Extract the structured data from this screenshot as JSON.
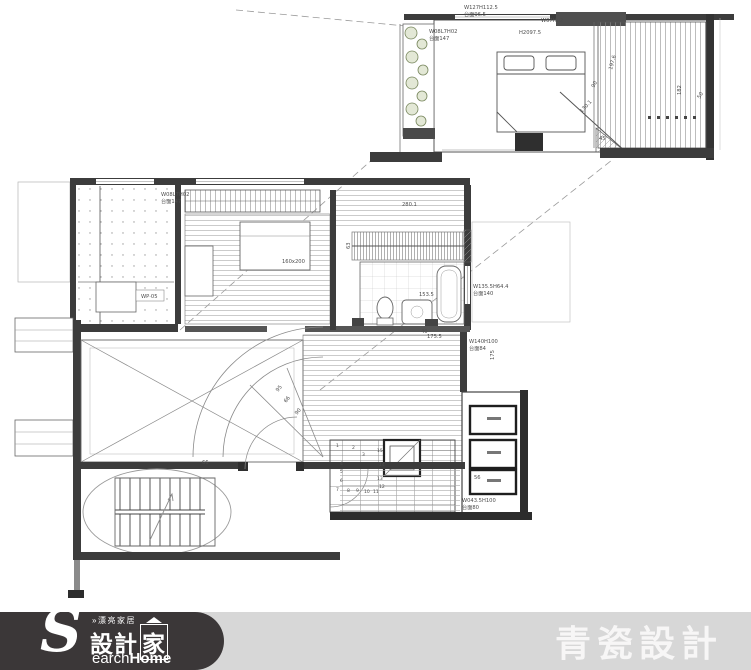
{
  "footer": {
    "logo": {
      "small_text": "»漂亮家居",
      "brand_s": "S",
      "brand_zh_prefix": "設計",
      "brand_zh_boxed": "家",
      "brand_en_rest": "earch",
      "brand_en_bold": "Home"
    },
    "studio_name": "青瓷設計",
    "colors": {
      "bar": "#d7d7d7",
      "logo_bg": "#3b3738",
      "text": "#ffffff"
    }
  },
  "plan": {
    "colors": {
      "wall": "#3c3c3c",
      "thin_line": "#8a8a8a",
      "plant": "#77865c"
    },
    "labels": [
      {
        "t": "W127H112.5",
        "x": 464,
        "y": 9
      },
      {
        "t": "台面96.5",
        "x": 464,
        "y": 16
      },
      {
        "t": "W07H02",
        "x": 541,
        "y": 22
      },
      {
        "t": "H2097.5",
        "x": 519,
        "y": 34
      },
      {
        "t": "W08L7H02",
        "x": 429,
        "y": 33
      },
      {
        "t": "台面147",
        "x": 429,
        "y": 40
      },
      {
        "t": "197.6",
        "x": 612,
        "y": 70,
        "r": -75
      },
      {
        "t": "90",
        "x": 594,
        "y": 88,
        "r": -60
      },
      {
        "t": "130.1",
        "x": 582,
        "y": 113,
        "r": -48
      },
      {
        "t": "45",
        "x": 599,
        "y": 140
      },
      {
        "t": "182",
        "x": 681,
        "y": 95,
        "r": -90
      },
      {
        "t": "50",
        "x": 700,
        "y": 99,
        "r": -60
      },
      {
        "t": "W08L7H02",
        "x": 161,
        "y": 196
      },
      {
        "t": "台面147",
        "x": 161,
        "y": 203
      },
      {
        "t": "280.1",
        "x": 402,
        "y": 206
      },
      {
        "t": "63",
        "x": 350,
        "y": 249,
        "r": -90
      },
      {
        "t": "160x200",
        "x": 282,
        "y": 263
      },
      {
        "t": "WP·05",
        "x": 141,
        "y": 298
      },
      {
        "t": "153.5",
        "x": 419,
        "y": 296
      },
      {
        "t": "40",
        "x": 421,
        "y": 333
      },
      {
        "t": "W135.5H64.4",
        "x": 473,
        "y": 288
      },
      {
        "t": "台面140",
        "x": 473,
        "y": 295
      },
      {
        "t": "W140H100",
        "x": 469,
        "y": 343
      },
      {
        "t": "台面84",
        "x": 469,
        "y": 350
      },
      {
        "t": "175",
        "x": 494,
        "y": 360,
        "r": -90
      },
      {
        "t": "175.5",
        "x": 427,
        "y": 338
      },
      {
        "t": "66",
        "x": 202,
        "y": 464
      },
      {
        "t": "95",
        "x": 278,
        "y": 392,
        "r": -50
      },
      {
        "t": "66",
        "x": 286,
        "y": 403,
        "r": -50
      },
      {
        "t": "90",
        "x": 297,
        "y": 415,
        "r": -50
      },
      {
        "t": "56",
        "x": 474,
        "y": 479
      },
      {
        "t": "W043.5H100",
        "x": 462,
        "y": 502
      },
      {
        "t": "台面80",
        "x": 462,
        "y": 509
      },
      {
        "t": "1",
        "x": 336,
        "y": 447,
        "s": 4.5
      },
      {
        "t": "2",
        "x": 352,
        "y": 449,
        "s": 4.5
      },
      {
        "t": "3",
        "x": 362,
        "y": 456,
        "s": 4.5
      },
      {
        "t": "4",
        "x": 340,
        "y": 465,
        "s": 4.5
      },
      {
        "t": "5",
        "x": 340,
        "y": 473,
        "s": 4.5
      },
      {
        "t": "6",
        "x": 340,
        "y": 482,
        "s": 4.5
      },
      {
        "t": "7",
        "x": 336,
        "y": 491,
        "s": 4.5
      },
      {
        "t": "8",
        "x": 347,
        "y": 492,
        "s": 4.5
      },
      {
        "t": "9",
        "x": 356,
        "y": 492,
        "s": 4.5
      },
      {
        "t": "10",
        "x": 364,
        "y": 493,
        "s": 4.5
      },
      {
        "t": "11",
        "x": 373,
        "y": 493,
        "s": 4.5
      },
      {
        "t": "12",
        "x": 379,
        "y": 488,
        "s": 4.5
      },
      {
        "t": "13",
        "x": 377,
        "y": 480,
        "s": 4.5
      },
      {
        "t": "14",
        "x": 379,
        "y": 466,
        "s": 4.5
      },
      {
        "t": "15",
        "x": 377,
        "y": 452,
        "s": 4.5
      }
    ]
  }
}
